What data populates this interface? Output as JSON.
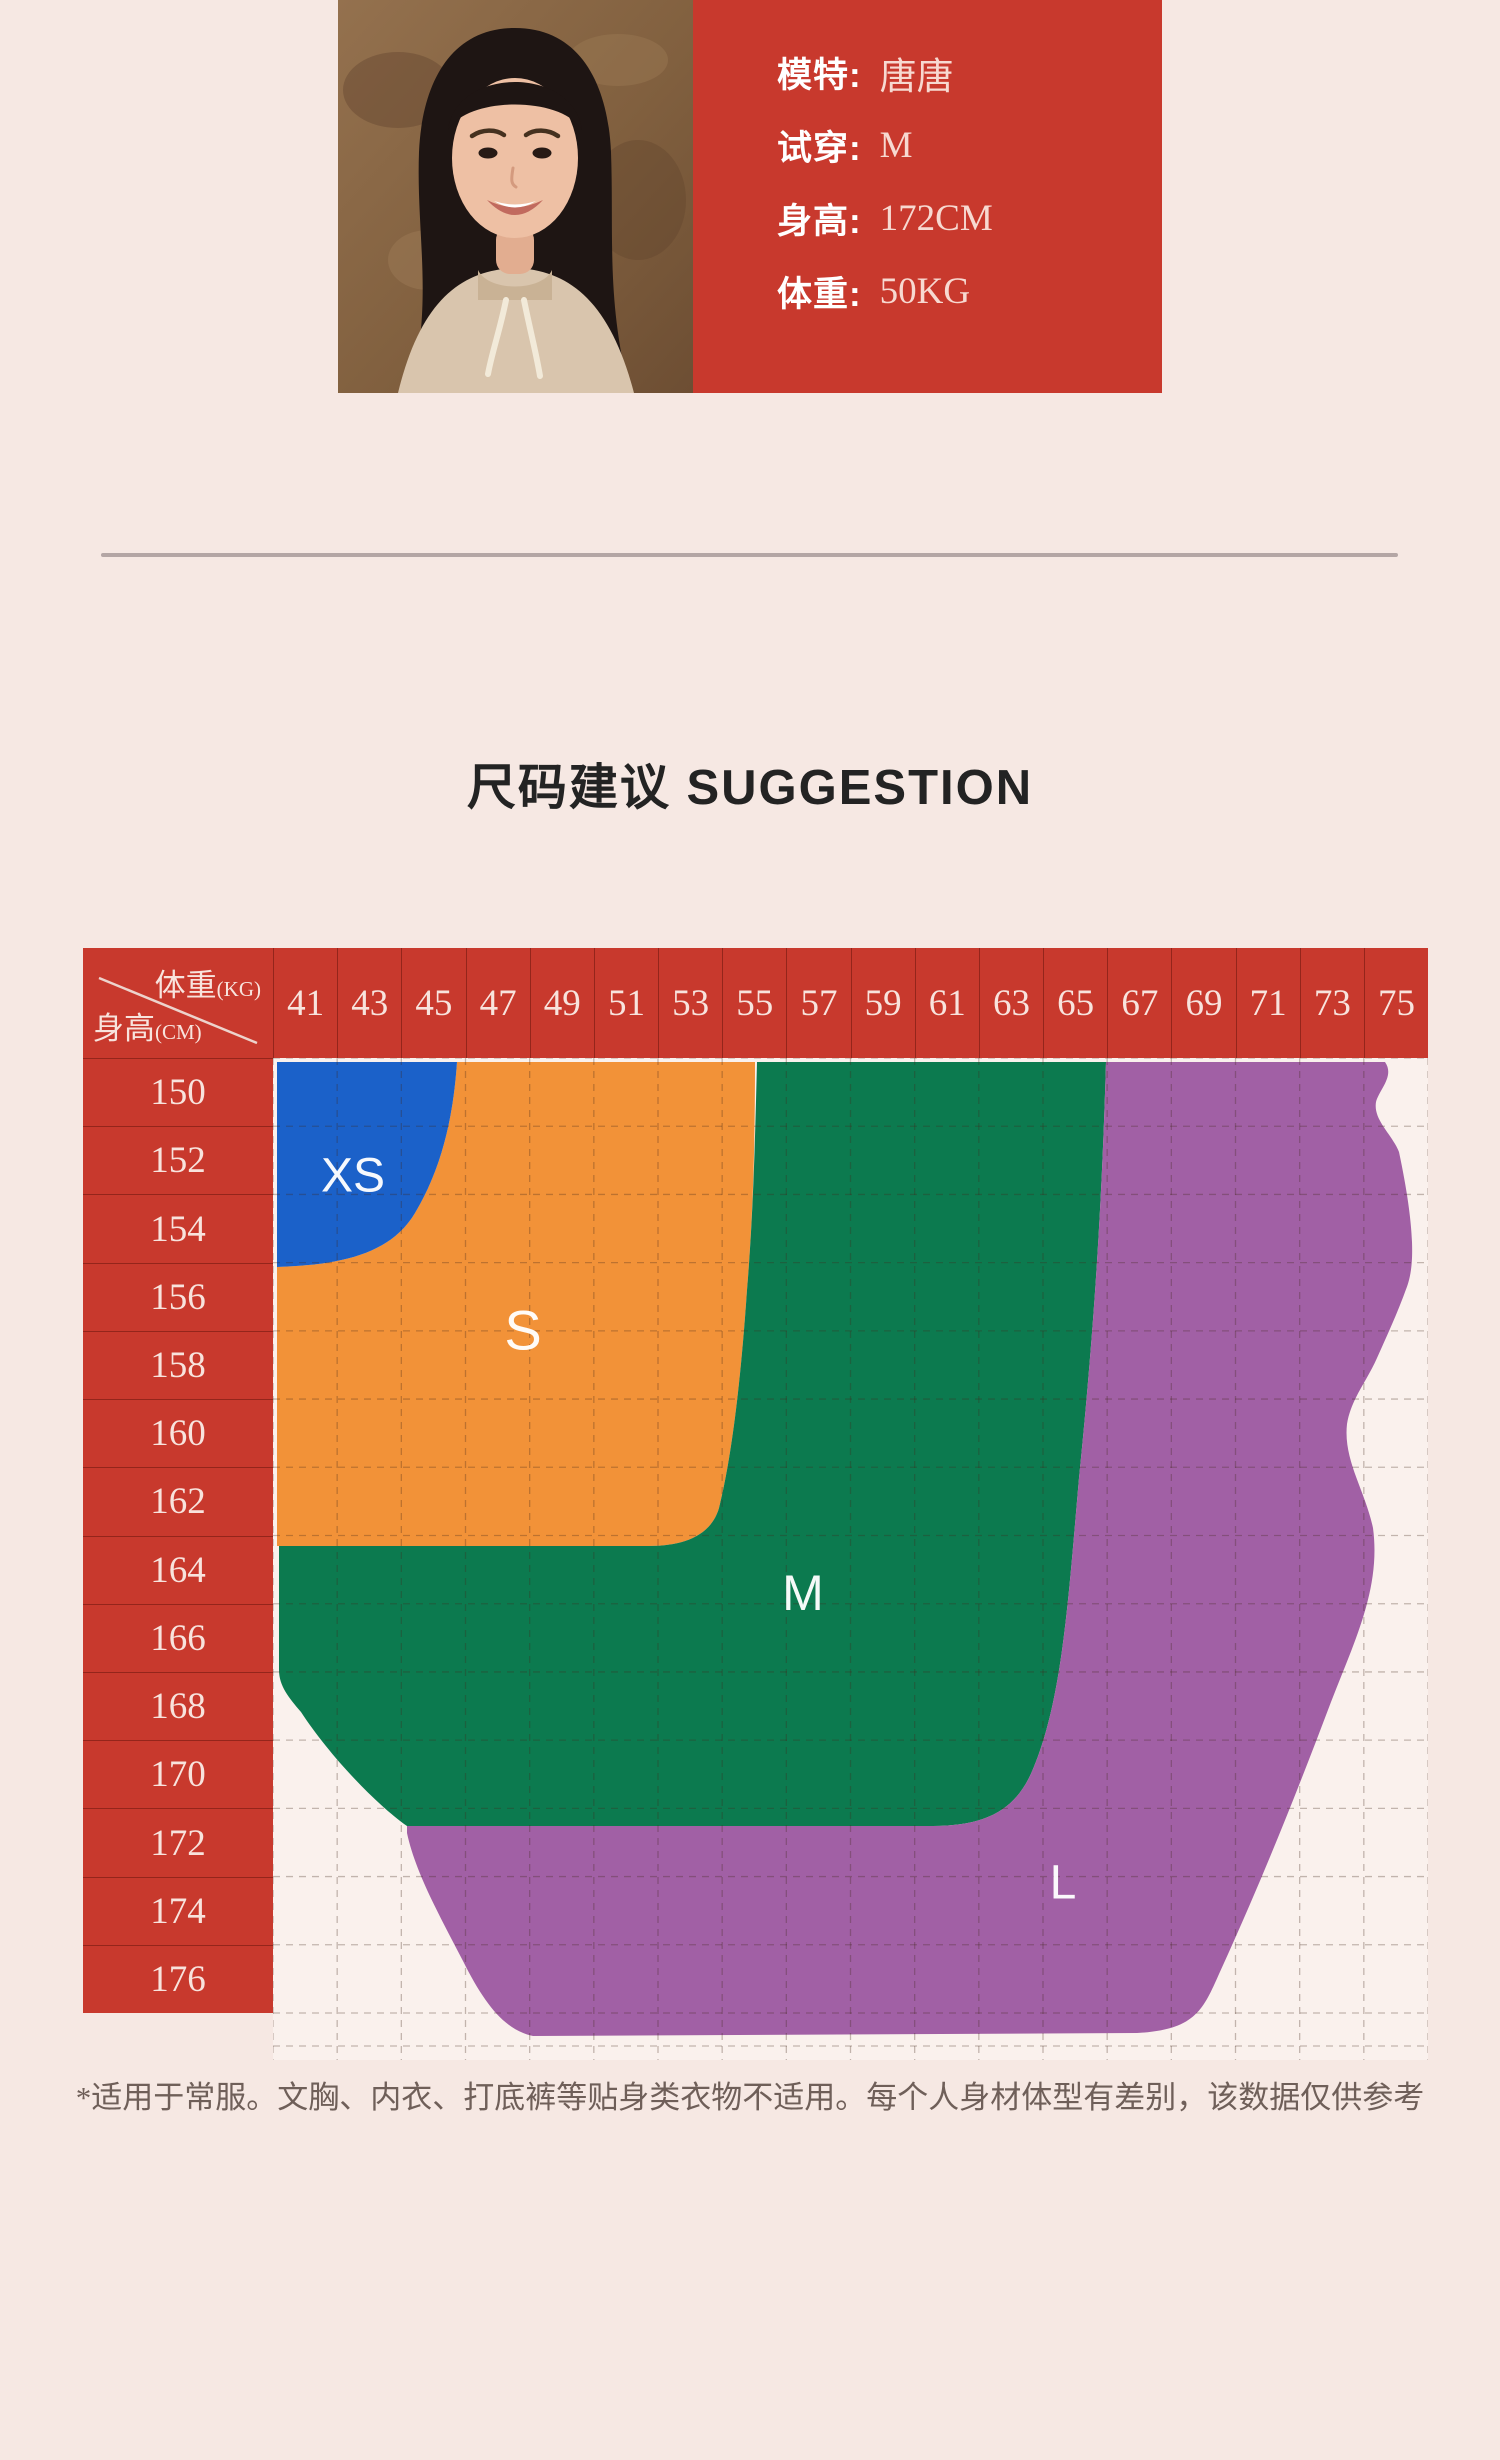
{
  "theme": {
    "bg": "#f6e8e3",
    "red": "#c8392d",
    "sep": "rgba(95,18,10,0.5)",
    "chart-bg": "#faf1ed",
    "grid-line": "rgba(66,40,28,0.3)",
    "divider": "#b4a6a5",
    "title-color": "#232323",
    "footnote-color": "#6f5f59",
    "card-label": "#ffffff",
    "card-value": "#f7d9d1",
    "header-text": "#f8e3dd"
  },
  "model_card": {
    "rows": [
      {
        "label": "模特:",
        "value": "唐唐"
      },
      {
        "label": "试穿:",
        "value": "M"
      },
      {
        "label": "身高:",
        "value": "172CM"
      },
      {
        "label": "体重:",
        "value": "50KG"
      }
    ]
  },
  "section": {
    "title": "尺码建议 SUGGESTION"
  },
  "chart_data": {
    "type": "heatmap",
    "title": "尺码建议 SUGGESTION",
    "x_axis": {
      "label": "体重",
      "unit_display": "(KG)",
      "values": [
        41,
        43,
        45,
        47,
        49,
        51,
        53,
        55,
        57,
        59,
        61,
        63,
        65,
        67,
        69,
        71,
        73,
        75
      ]
    },
    "y_axis": {
      "label": "身高",
      "unit_display": "(CM)",
      "values": [
        150,
        152,
        154,
        156,
        158,
        160,
        162,
        164,
        166,
        168,
        170,
        172,
        174,
        176
      ]
    },
    "grid": "dashed",
    "legend_position": "in-plot-labels",
    "regions": [
      {
        "label": "XS",
        "color": "#1b61c9",
        "weight_range": [
          41,
          46
        ],
        "height_range": [
          150,
          155
        ],
        "label_x": 80,
        "label_y": 118,
        "label_size": 48,
        "path": "M4,4 L184,4 C180,64 167,113 142,155 C117,197 66,207 4,209 Z"
      },
      {
        "label": "S",
        "color": "#f29238",
        "weight_range": [
          41,
          56
        ],
        "height_range": [
          150,
          164
        ],
        "label_x": 250,
        "label_y": 272,
        "label_size": 56,
        "path": "M184,4 L482,4 C482,86 480,160 474,232 C468,320 459,398 446,450 C438,478 410,488 376,488 L4,488 L4,209 C66,207 117,197 142,155 C167,113 180,64 184,4 Z"
      },
      {
        "label": "M",
        "color": "#0c7a4f",
        "weight_range": [
          41,
          66
        ],
        "height_range": [
          150,
          171
        ],
        "label_x": 530,
        "label_y": 535,
        "label_size": 50,
        "path": "M484,4 L833,4 C829,140 822,262 806,420 C795,546 789,642 760,711 C744,750 716,768 660,768 L134,768 C100,744 54,694 28,654 C16,640 6,628 6,612 L6,488 L376,488 C410,488 438,478 446,450 C459,398 468,320 474,232 C480,160 482,86 484,4 Z"
      },
      {
        "label": "L",
        "color": "#a160a5",
        "weight_range": [
          45,
          75
        ],
        "height_range": [
          150,
          177
        ],
        "label_x": 790,
        "label_y": 825,
        "label_size": 48,
        "path": "M833,4 L1112,4 C1122,18 1106,32 1103,44 C1100,62 1119,76 1126,94 C1134,132 1138,160 1139,184 C1140,212 1136,224 1132,234 C1124,256 1112,282 1104,300 C1094,323 1078,341 1074,366 C1070,402 1092,432 1100,470 C1108,530 1082,582 1058,644 C1021,742 988,824 946,916 C930,952 922,972 864,975 L260,978 C232,972 212,947 190,903 C166,857 142,813 134,775 L134,768 L660,768 C716,768 744,750 760,711 C789,642 795,546 806,420 C822,262 829,140 833,4 Z"
      }
    ],
    "footnote": "*适用于常服。文胸、内衣、打底裤等贴身类衣物不适用。每个人身材体型有差别，该数据仅供参考"
  }
}
